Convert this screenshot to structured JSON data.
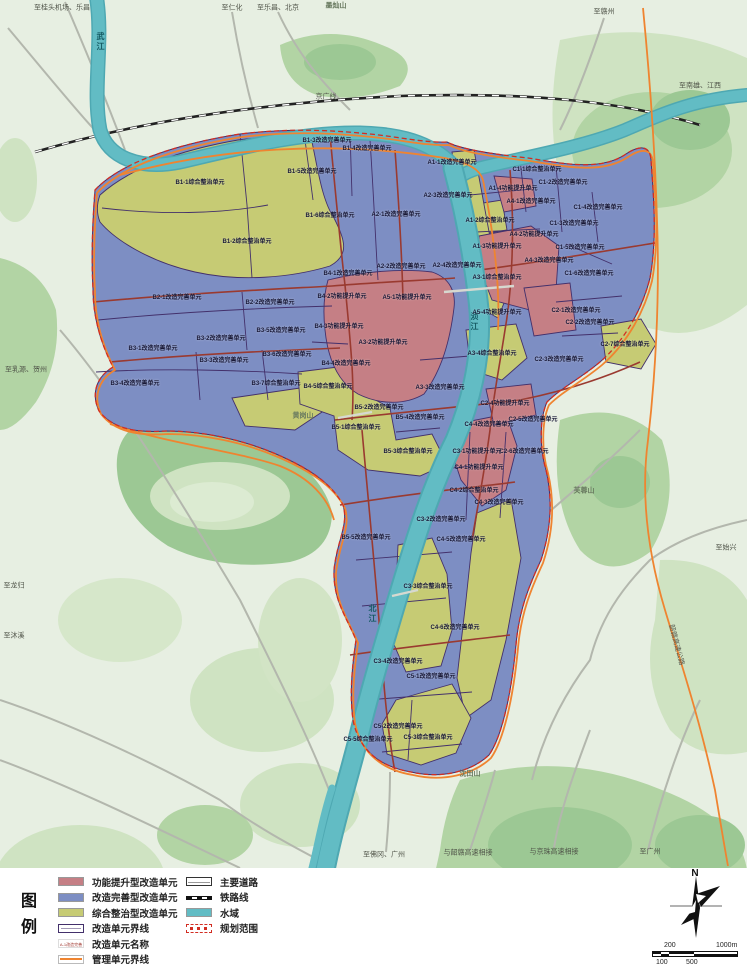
{
  "palette": {
    "unit_red": "#c57f85",
    "unit_blue": "#7d8ec3",
    "unit_yellow": "#c6cb74",
    "water": "#62bcc4",
    "water_edge": "#4ea8b2",
    "bg": "#e7efe2",
    "forest_light": "#cfe3c2",
    "forest_mid": "#b2d4a4",
    "forest_dark": "#9cc894",
    "boundary_purple": "#43306b",
    "road_red": "#9a3a30",
    "mgmt_orange": "#ef8430",
    "scope_red": "#d22d22",
    "road_gray": "#b3b7ad",
    "rail_black": "#222222"
  },
  "compass": {
    "north_label": "N"
  },
  "scalebar": {
    "top_left": "200",
    "top_right": "1000m",
    "bottom_left": "100",
    "bottom_mid": "500"
  },
  "legend": {
    "title": "图例",
    "columns": [
      [
        {
          "type": "fill",
          "color_key": "unit_red",
          "label": "功能提升型改造单元"
        },
        {
          "type": "fill",
          "color_key": "unit_blue",
          "label": "改造完善型改造单元"
        },
        {
          "type": "fill",
          "color_key": "unit_yellow",
          "label": "综合整治型改造单元"
        },
        {
          "type": "outline_purple",
          "label": "改造单元界线"
        },
        {
          "type": "name_sample",
          "sample": "A-1改造完善单元",
          "label": "改造单元名称"
        },
        {
          "type": "outline_orange",
          "label": "管理单元界线"
        }
      ],
      [
        {
          "type": "road",
          "label": "主要道路"
        },
        {
          "type": "rail",
          "label": "铁路线"
        },
        {
          "type": "fill",
          "color_key": "water",
          "label": "水域"
        },
        {
          "type": "scope",
          "label": "规划范围"
        }
      ]
    ]
  },
  "map_labels": [
    {
      "t": "至桂头机场、乐昌",
      "x": 62,
      "y": 8,
      "c": "e"
    },
    {
      "t": "至仁化",
      "x": 232,
      "y": 8,
      "c": "e"
    },
    {
      "t": "至乐昌、北京",
      "x": 278,
      "y": 8,
      "c": "e"
    },
    {
      "t": "墨灿山",
      "x": 336,
      "y": 6,
      "c": "p"
    },
    {
      "t": "至赣州",
      "x": 604,
      "y": 12,
      "c": "e"
    },
    {
      "t": "至南雄、江西",
      "x": 700,
      "y": 86,
      "c": "e"
    },
    {
      "t": "京广线",
      "x": 326,
      "y": 97,
      "c": "d"
    },
    {
      "t": "武江",
      "x": 100,
      "y": 42,
      "c": "r"
    },
    {
      "t": "浈江",
      "x": 474,
      "y": 322,
      "c": "r"
    },
    {
      "t": "北江",
      "x": 372,
      "y": 614,
      "c": "r"
    },
    {
      "t": "至乳源、贺州",
      "x": 26,
      "y": 370,
      "c": "e"
    },
    {
      "t": "黄岗山",
      "x": 303,
      "y": 416,
      "c": "p"
    },
    {
      "t": "芙蓉山",
      "x": 584,
      "y": 491,
      "c": "p"
    },
    {
      "t": "沈田山",
      "x": 470,
      "y": 774,
      "c": "p"
    },
    {
      "t": "至始兴",
      "x": 726,
      "y": 548,
      "c": "e"
    },
    {
      "t": "韶赣高速公路",
      "x": 676,
      "y": 645,
      "c": "d",
      "rot": 75
    },
    {
      "t": "至龙归",
      "x": 14,
      "y": 586,
      "c": "e"
    },
    {
      "t": "至沐溪",
      "x": 14,
      "y": 636,
      "c": "e"
    },
    {
      "t": "至佛冈、广州",
      "x": 384,
      "y": 855,
      "c": "e"
    },
    {
      "t": "与韶赣高速相接",
      "x": 468,
      "y": 853,
      "c": "e"
    },
    {
      "t": "与京珠高速相接",
      "x": 554,
      "y": 852,
      "c": "e"
    },
    {
      "t": "至广州",
      "x": 650,
      "y": 852,
      "c": "e"
    },
    {
      "t": "B1-1综合整治单元",
      "x": 200,
      "y": 183,
      "c": "u"
    },
    {
      "t": "B1-2综合整治单元",
      "x": 247,
      "y": 242,
      "c": "u"
    },
    {
      "t": "B1-3改造完善单元",
      "x": 327,
      "y": 141,
      "c": "u"
    },
    {
      "t": "B1-4改造完善单元",
      "x": 367,
      "y": 149,
      "c": "u"
    },
    {
      "t": "B1-5改造完善单元",
      "x": 312,
      "y": 172,
      "c": "u"
    },
    {
      "t": "B1-6综合整治单元",
      "x": 330,
      "y": 216,
      "c": "u"
    },
    {
      "t": "B2-1改造完善单元",
      "x": 177,
      "y": 298,
      "c": "u"
    },
    {
      "t": "B2-2改造完善单元",
      "x": 270,
      "y": 303,
      "c": "u"
    },
    {
      "t": "B3-1改造完善单元",
      "x": 153,
      "y": 349,
      "c": "u"
    },
    {
      "t": "B3-2改造完善单元",
      "x": 221,
      "y": 339,
      "c": "u"
    },
    {
      "t": "B3-3改造完善单元",
      "x": 224,
      "y": 361,
      "c": "u"
    },
    {
      "t": "B3-4改造完善单元",
      "x": 135,
      "y": 384,
      "c": "u"
    },
    {
      "t": "B3-5改造完善单元",
      "x": 281,
      "y": 331,
      "c": "u"
    },
    {
      "t": "B3-6改造完善单元",
      "x": 287,
      "y": 355,
      "c": "u"
    },
    {
      "t": "B3-7综合整治单元",
      "x": 276,
      "y": 384,
      "c": "u"
    },
    {
      "t": "B4-1改造完善单元",
      "x": 348,
      "y": 274,
      "c": "u"
    },
    {
      "t": "B4-2功能提升单元",
      "x": 342,
      "y": 297,
      "c": "u"
    },
    {
      "t": "B4-3功能提升单元",
      "x": 339,
      "y": 327,
      "c": "u"
    },
    {
      "t": "B4-4改造完善单元",
      "x": 346,
      "y": 364,
      "c": "u"
    },
    {
      "t": "B4-5综合整治单元",
      "x": 328,
      "y": 387,
      "c": "u"
    },
    {
      "t": "B5-1综合整治单元",
      "x": 356,
      "y": 428,
      "c": "u"
    },
    {
      "t": "B5-2改造完善单元",
      "x": 379,
      "y": 408,
      "c": "u"
    },
    {
      "t": "B5-3综合整治单元",
      "x": 408,
      "y": 452,
      "c": "u"
    },
    {
      "t": "B5-4改造完善单元",
      "x": 420,
      "y": 418,
      "c": "u"
    },
    {
      "t": "B5-5改造完善单元",
      "x": 366,
      "y": 538,
      "c": "u"
    },
    {
      "t": "A1-1改造完善单元",
      "x": 452,
      "y": 163,
      "c": "u"
    },
    {
      "t": "A1-2综合整治单元",
      "x": 490,
      "y": 221,
      "c": "u"
    },
    {
      "t": "A1-3功能提升单元",
      "x": 497,
      "y": 247,
      "c": "u"
    },
    {
      "t": "A1-4功能提升单元",
      "x": 513,
      "y": 189,
      "c": "u"
    },
    {
      "t": "A2-1改造完善单元",
      "x": 396,
      "y": 215,
      "c": "u"
    },
    {
      "t": "A2-2改造完善单元",
      "x": 401,
      "y": 267,
      "c": "u"
    },
    {
      "t": "A2-3改造完善单元",
      "x": 448,
      "y": 196,
      "c": "u"
    },
    {
      "t": "A2-4改造完善单元",
      "x": 457,
      "y": 266,
      "c": "u"
    },
    {
      "t": "A3-1综合整治单元",
      "x": 497,
      "y": 278,
      "c": "u"
    },
    {
      "t": "A3-2功能提升单元",
      "x": 383,
      "y": 343,
      "c": "u"
    },
    {
      "t": "A3-3改造完善单元",
      "x": 440,
      "y": 388,
      "c": "u"
    },
    {
      "t": "A3-4综合整治单元",
      "x": 492,
      "y": 354,
      "c": "u"
    },
    {
      "t": "A4-1改造完善单元",
      "x": 531,
      "y": 202,
      "c": "u"
    },
    {
      "t": "A4-2功能提升单元",
      "x": 534,
      "y": 235,
      "c": "u"
    },
    {
      "t": "A4-3改造完善单元",
      "x": 549,
      "y": 261,
      "c": "u"
    },
    {
      "t": "A5-1功能提升单元",
      "x": 407,
      "y": 298,
      "c": "u"
    },
    {
      "t": "A5-4功能提升单元",
      "x": 497,
      "y": 313,
      "c": "u"
    },
    {
      "t": "C1-1综合整治单元",
      "x": 537,
      "y": 170,
      "c": "u"
    },
    {
      "t": "C1-2改造完善单元",
      "x": 563,
      "y": 183,
      "c": "u"
    },
    {
      "t": "C1-3改造完善单元",
      "x": 574,
      "y": 224,
      "c": "u"
    },
    {
      "t": "C1-4改造完善单元",
      "x": 598,
      "y": 208,
      "c": "u"
    },
    {
      "t": "C1-5改造完善单元",
      "x": 580,
      "y": 248,
      "c": "u"
    },
    {
      "t": "C1-6改造完善单元",
      "x": 589,
      "y": 274,
      "c": "u"
    },
    {
      "t": "C2-1改造完善单元",
      "x": 576,
      "y": 311,
      "c": "u"
    },
    {
      "t": "C2-2改造完善单元",
      "x": 590,
      "y": 323,
      "c": "u"
    },
    {
      "t": "C2-3改造完善单元",
      "x": 559,
      "y": 360,
      "c": "u"
    },
    {
      "t": "C2-4功能提升单元",
      "x": 505,
      "y": 404,
      "c": "u"
    },
    {
      "t": "C2-5改造完善单元",
      "x": 533,
      "y": 420,
      "c": "u"
    },
    {
      "t": "C2-6改造完善单元",
      "x": 524,
      "y": 452,
      "c": "u"
    },
    {
      "t": "C2-7综合整治单元",
      "x": 625,
      "y": 345,
      "c": "u"
    },
    {
      "t": "C3-1功能提升单元",
      "x": 477,
      "y": 452,
      "c": "u"
    },
    {
      "t": "C3-2改造完善单元",
      "x": 441,
      "y": 520,
      "c": "u"
    },
    {
      "t": "C3-3综合整治单元",
      "x": 428,
      "y": 587,
      "c": "u"
    },
    {
      "t": "C3-4改造完善单元",
      "x": 398,
      "y": 662,
      "c": "u"
    },
    {
      "t": "C4-1功能提升单元",
      "x": 479,
      "y": 468,
      "c": "u"
    },
    {
      "t": "C4-2综合整治单元",
      "x": 474,
      "y": 491,
      "c": "u"
    },
    {
      "t": "C4-3改造完善单元",
      "x": 499,
      "y": 503,
      "c": "u"
    },
    {
      "t": "C4-4改造完善单元",
      "x": 489,
      "y": 425,
      "c": "u"
    },
    {
      "t": "C4-5改造完善单元",
      "x": 461,
      "y": 540,
      "c": "u"
    },
    {
      "t": "C4-6改造完善单元",
      "x": 455,
      "y": 628,
      "c": "u"
    },
    {
      "t": "C5-1改造完善单元",
      "x": 431,
      "y": 677,
      "c": "u"
    },
    {
      "t": "C5-2改造完善单元",
      "x": 398,
      "y": 727,
      "c": "u"
    },
    {
      "t": "C5-3综合整治单元",
      "x": 428,
      "y": 738,
      "c": "u"
    },
    {
      "t": "C5-5综合整治单元",
      "x": 368,
      "y": 740,
      "c": "u"
    }
  ]
}
